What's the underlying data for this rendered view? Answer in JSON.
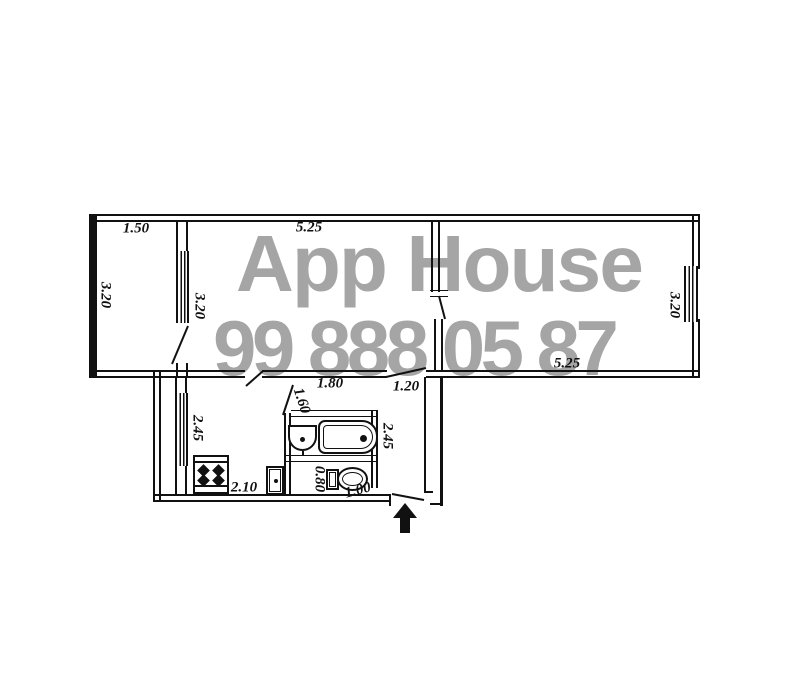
{
  "watermark": {
    "line1": "App House",
    "line2": "99 888 05 87",
    "color": "#a5a5a5"
  },
  "plan": {
    "line_color": "#111111",
    "type": "apartment-floor-plan",
    "dims": [
      {
        "id": "balcony-width",
        "text": "1.50"
      },
      {
        "id": "balcony-depth",
        "text": "3.20"
      },
      {
        "id": "room1-width",
        "text": "5.25"
      },
      {
        "id": "room1-depth",
        "text": "3.20"
      },
      {
        "id": "room2-depth",
        "text": "3.20"
      },
      {
        "id": "room2-width",
        "text": "5.25"
      },
      {
        "id": "kitchen-depth",
        "text": "2.45"
      },
      {
        "id": "kitchen-width",
        "text": "2.10"
      },
      {
        "id": "bathroom-depth",
        "text": "1.60"
      },
      {
        "id": "bathroom-width",
        "text": "1.80"
      },
      {
        "id": "hallway-width",
        "text": "1.20"
      },
      {
        "id": "hallway-depth",
        "text": "2.45"
      },
      {
        "id": "toilet-depth",
        "text": "0.80"
      },
      {
        "id": "toilet-width",
        "text": "1.00"
      }
    ],
    "fixtures": [
      "stove",
      "refrigerator",
      "washbasin",
      "bathtub",
      "toilet"
    ],
    "symbols": [
      "window",
      "door-leaf",
      "entrance-arrow"
    ]
  }
}
